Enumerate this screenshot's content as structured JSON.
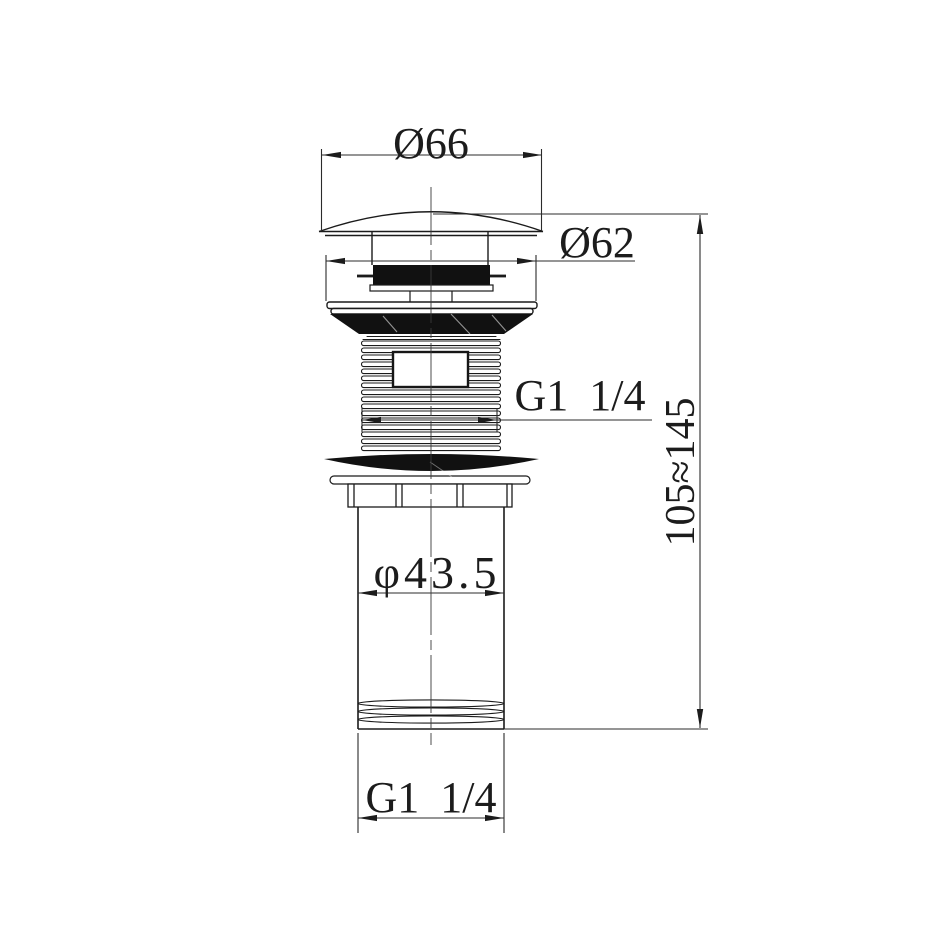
{
  "page": {
    "background": "#ffffff",
    "line_color": "#1b1b1b",
    "fill_color": "#111111",
    "dim_line_color": "#2b2b2b"
  },
  "drawing": {
    "labels": {
      "cap_diameter": "Ø66",
      "flange_diameter": "Ø62",
      "top_thread": "G1 1/4",
      "height_range": "105≈145",
      "body_diameter": "φ43.5",
      "bottom_thread": "G1 1/4"
    },
    "dimensions": [
      {
        "id": "cap_diameter",
        "label": "Ø66",
        "value": 66
      },
      {
        "id": "flange_diameter",
        "label": "Ø62",
        "value": 62
      },
      {
        "id": "top_thread",
        "label": "G1 1/4"
      },
      {
        "id": "height_range",
        "label": "105≈145",
        "min": 105,
        "max": 145
      },
      {
        "id": "body_diameter",
        "label": "φ43.5",
        "value": 43.5
      },
      {
        "id": "bottom_thread",
        "label": "G1 1/4"
      }
    ]
  }
}
